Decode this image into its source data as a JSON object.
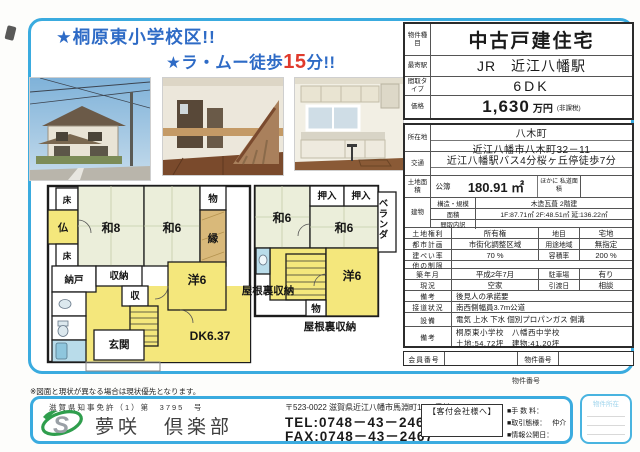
{
  "headlines": {
    "line1": "★桐原東小学校区!!",
    "line2_prefix": "★ラ・ムー徒歩",
    "line2_highlight": "15",
    "line2_suffix": "分!!"
  },
  "colors": {
    "frame_blue": "#3aabdf",
    "headline_blue": "#2e6bc6",
    "highlight_red": "#e03a2c",
    "room_yellow": "#f4e77c",
    "tatami_green": "#ebeeda"
  },
  "property_table": {
    "type": {
      "label": "物件種目",
      "value": "中古戸建住宅"
    },
    "station": {
      "label": "最寄駅",
      "value": "JR　近江八幡駅"
    },
    "layout": {
      "label": "間取タイプ",
      "value": "6DK"
    },
    "price": {
      "label": "価格",
      "value": "1,630",
      "unit": "万円",
      "note": "(非課税)"
    },
    "location": {
      "label": "所在地",
      "line1": "八木町",
      "line2": "近江八幡市八木町32－11"
    },
    "access": {
      "label": "交通",
      "value": "近江八幡駅バス4分桜ヶ丘停徒歩7分"
    },
    "land": {
      "label": "土地面積",
      "register": "公簿",
      "value": "180.91 ㎡",
      "note": "ほかに 私道面積"
    },
    "building": {
      "label": "建物",
      "structure_label": "構造・規模",
      "structure": "木造瓦葺 2階建",
      "area_label": "面積",
      "area": "1F:87.71㎡ 2F:48.51㎡ 延:136.22㎡",
      "madori_label": "間取内訳",
      "madori": ""
    },
    "rights": {
      "label": "土地権利",
      "value": "所有権",
      "label2": "地目",
      "value2": "宅地"
    },
    "cityplan": {
      "label": "都市計画",
      "value": "市街化調整区域",
      "label2": "用途地域",
      "value2": "無指定"
    },
    "coverage": {
      "label": "建ぺい率",
      "value": "70 %",
      "label2": "容積率",
      "value2": "200 %"
    },
    "other": {
      "label": "他の制限",
      "value": ""
    },
    "built": {
      "label": "築年月",
      "value": "平成2年7月",
      "label2": "駐車場",
      "value2": "有り"
    },
    "status": {
      "label": "現況",
      "value": "空家",
      "label2": "引渡日",
      "value2": "相談"
    },
    "remarks1": {
      "label": "備考",
      "value": "後見人の承諾要"
    },
    "road": {
      "label": "接道状況",
      "value": "南西側幅員3.7m公道"
    },
    "facilities": {
      "label": "設備",
      "value": "電気 上水 下水 個別プロパンガス 側溝"
    },
    "remarks2": {
      "label": "備考",
      "line1": "桐原東小学校　八幡西中学校",
      "line2": "土地:54.72坪　建物:41.20坪"
    },
    "member": {
      "label": "会員番号",
      "value": "",
      "label2": "物件番号",
      "value2": ""
    }
  },
  "floorplan": {
    "f1": {
      "toko1": "床",
      "butsu": "仏",
      "toko2": "床",
      "wa8": "和8",
      "wa6": "和6",
      "mono": "物",
      "en": "縁",
      "nando": "納戸",
      "shuno": "収納",
      "shu": "収",
      "yo6": "洋6",
      "dk": "DK6.37",
      "genkan": "玄関"
    },
    "f2": {
      "oshiire1": "押入",
      "oshiire2": "押入",
      "veranda": "ベランダ",
      "wa6a": "和6",
      "wa6b": "和6",
      "yo6": "洋6",
      "mono": "物",
      "yaneura1": "屋根裏収納",
      "yaneura2": "屋根裏収納"
    }
  },
  "footer": {
    "disclaimer": "※図面と現状が異なる場合は現状優先となります。",
    "bukken_no_note": "物件番号",
    "license": "滋賀県知事免許（1）第　3795　号",
    "company": "夢咲　倶楽部",
    "address": "〒523-0022 滋賀県近江八幡市馬淵町1664番地11",
    "tel": "TEL:0748－43－2468",
    "fax": "FAX:0748－43－2467",
    "agent_box_title": "【客付会社様へ】",
    "fee_label": "■手 数 料：",
    "deal_label": "■取引態様：",
    "deal_value": "仲介",
    "publish_label": "■情報公開日：",
    "side_box_label": "物件所在"
  }
}
